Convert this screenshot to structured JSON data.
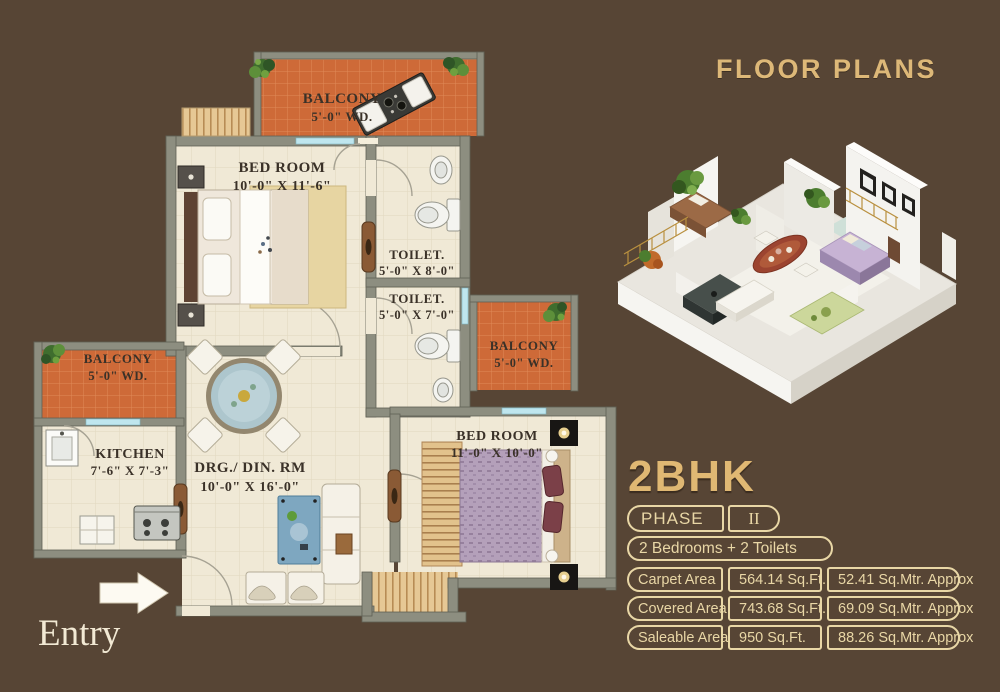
{
  "header": {
    "title": "FLOOR PLANS"
  },
  "plan": {
    "entry_label": "Entry",
    "rooms": {
      "balcony_top": {
        "name": "BALCONY",
        "dim": "5'-0\" WD."
      },
      "bedroom1": {
        "name": "BED ROOM",
        "dim": "10'-0\" X 11'-6\""
      },
      "toilet1": {
        "name": "TOILET.",
        "dim": "5'-0\" X 8'-0\""
      },
      "toilet2": {
        "name": "TOILET.",
        "dim": "5'-0\" X 7'-0\""
      },
      "balcony_left": {
        "name": "BALCONY",
        "dim": "5'-0\" WD."
      },
      "balcony_right": {
        "name": "BALCONY",
        "dim": "5'-0\" WD."
      },
      "kitchen": {
        "name": "KITCHEN",
        "dim": "7'-6\" X 7'-3\""
      },
      "drg_din": {
        "name": "DRG./ DIN. RM",
        "dim": "10'-0\" X 16'-0\""
      },
      "bedroom2": {
        "name": "BED ROOM",
        "dim": "11'-0\" X 10'-0\""
      }
    }
  },
  "unit": {
    "type": "2BHK",
    "phase_label": "PHASE",
    "phase_value": "II",
    "config": "2 Bedrooms + 2 Toilets",
    "areas": [
      {
        "label": "Carpet Area",
        "sqft": "564.14 Sq.Ft.",
        "sqmtr": "52.41 Sq.Mtr. Approx"
      },
      {
        "label": "Covered Area",
        "sqft": "743.68 Sq.Ft.",
        "sqmtr": "69.09 Sq.Mtr. Approx"
      },
      {
        "label": "Saleable Area",
        "sqft": "950 Sq.Ft.",
        "sqmtr": "88.26 Sq.Mtr. Approx"
      }
    ]
  },
  "colors": {
    "background": "#574535",
    "heading_gold": "#ddb878",
    "pill_cream": "#e9d7a6",
    "balcony_tile": "#ce6a38",
    "wall_gray": "#8d8e80",
    "floor_cream": "#f0e9d6",
    "window_blue": "#bfe6ee",
    "bed_purple": "#b4a0ba"
  }
}
